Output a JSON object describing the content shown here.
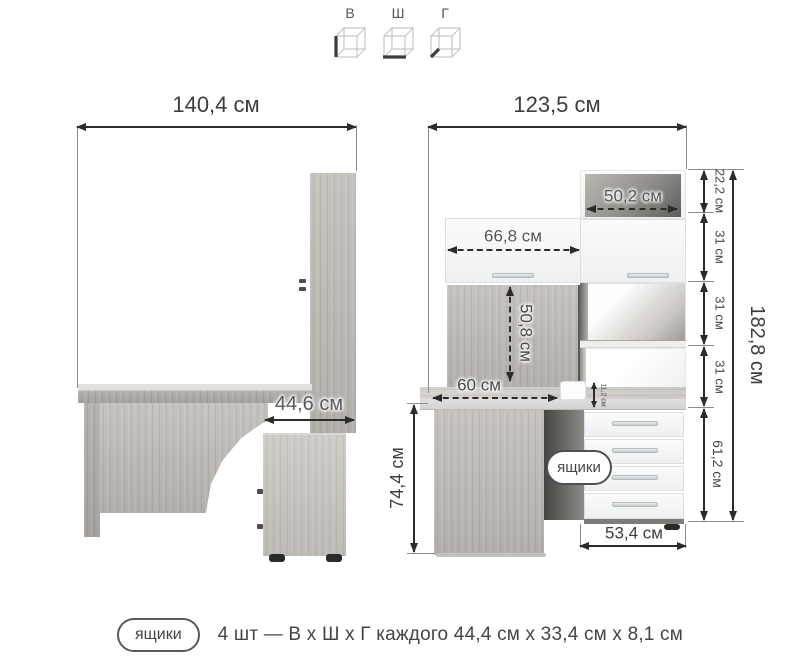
{
  "legend": {
    "height": "В",
    "width": "Ш",
    "depth": "Г"
  },
  "side": {
    "total_width": "140,4 см",
    "unit_depth": "44,6 см"
  },
  "front": {
    "total_width": "123,5 см",
    "niche_width": "50,2 см",
    "door_width": "66,8 см",
    "back_height": "50,8 см",
    "desk_depth": "60 см",
    "ledge_height": "11,2 см",
    "seg1": "22,2 см",
    "seg2": "31 см",
    "seg3": "31 см",
    "seg4": "31 см",
    "drawers_height": "61,2 см",
    "total_height": "182,8 см",
    "desk_height": "74,4 см",
    "drawers_width": "53,4 см",
    "badge": "ящики"
  },
  "footer": {
    "badge": "ящики",
    "text": "4 шт — В х Ш х Г каждого 44,4 см х 33,4 см х 8,1 см"
  },
  "colors": {
    "line": "#2b2b2b",
    "label": "#454545",
    "wood": "#bcb9b4",
    "panel_white": "#f7f8f8",
    "interior_dark": "#615f5c"
  }
}
